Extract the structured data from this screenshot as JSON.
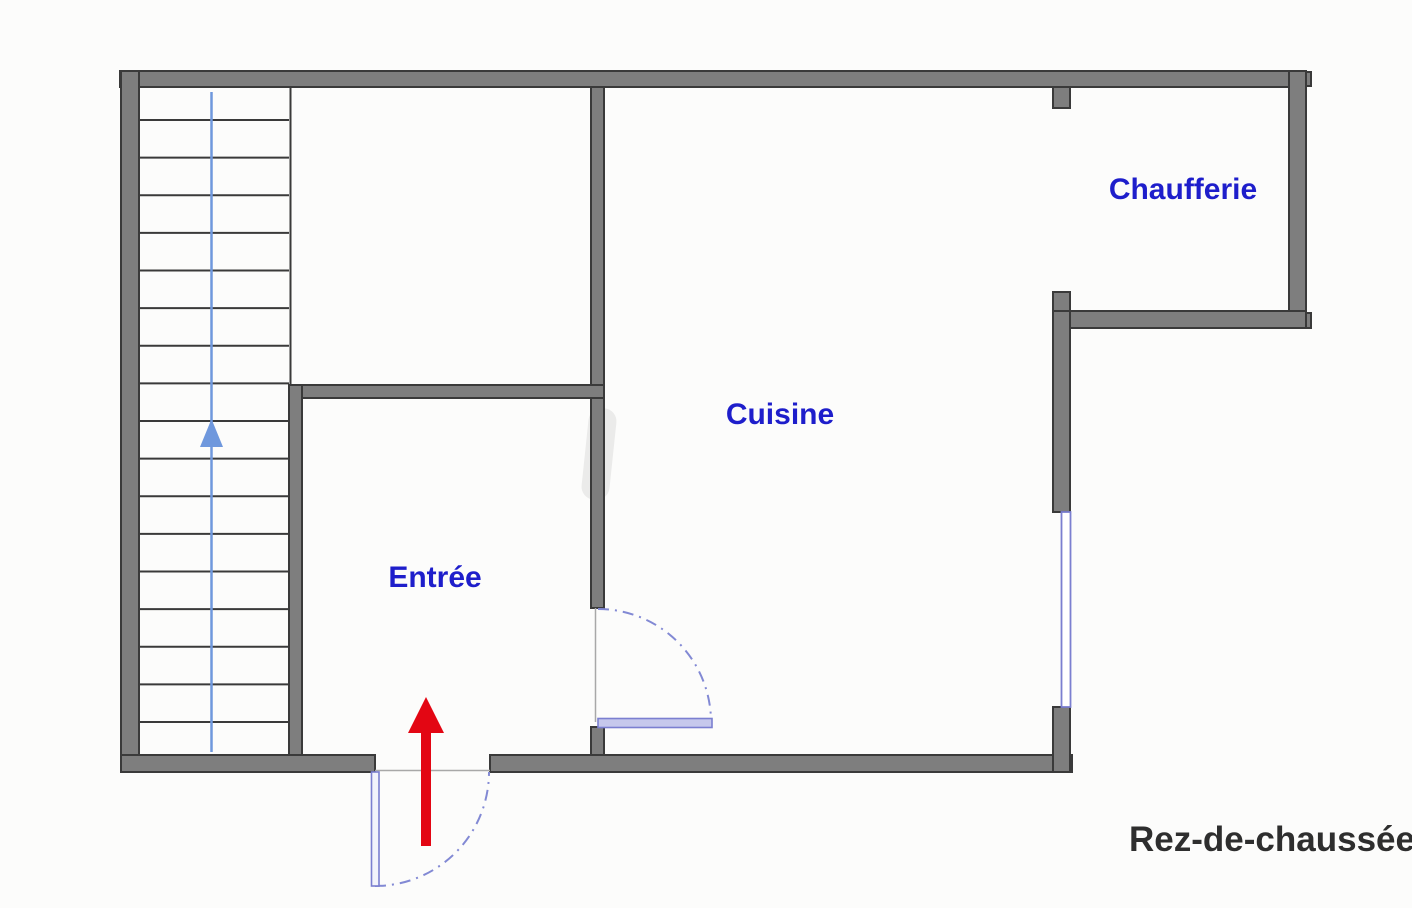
{
  "floor_plan": {
    "title": "Rez-de-chaussée",
    "rooms": {
      "entree": {
        "label": "Entrée"
      },
      "cuisine": {
        "label": "Cuisine"
      },
      "chaufferie": {
        "label": "Chaufferie"
      }
    },
    "stairs": {
      "tread_count": 18,
      "direction": "up"
    },
    "colors": {
      "wall_fill": "#7e7e7e",
      "wall_outline": "#3a3a3a",
      "room_label": "#1e1ecb",
      "title_text": "#2e2e2e",
      "door_swing": "#8289d4",
      "door_leaf": "#7b7fd0",
      "window": "#7b7fd0",
      "stair_guide": "#6f98dd",
      "entrance_arrow": "#e30613"
    }
  }
}
